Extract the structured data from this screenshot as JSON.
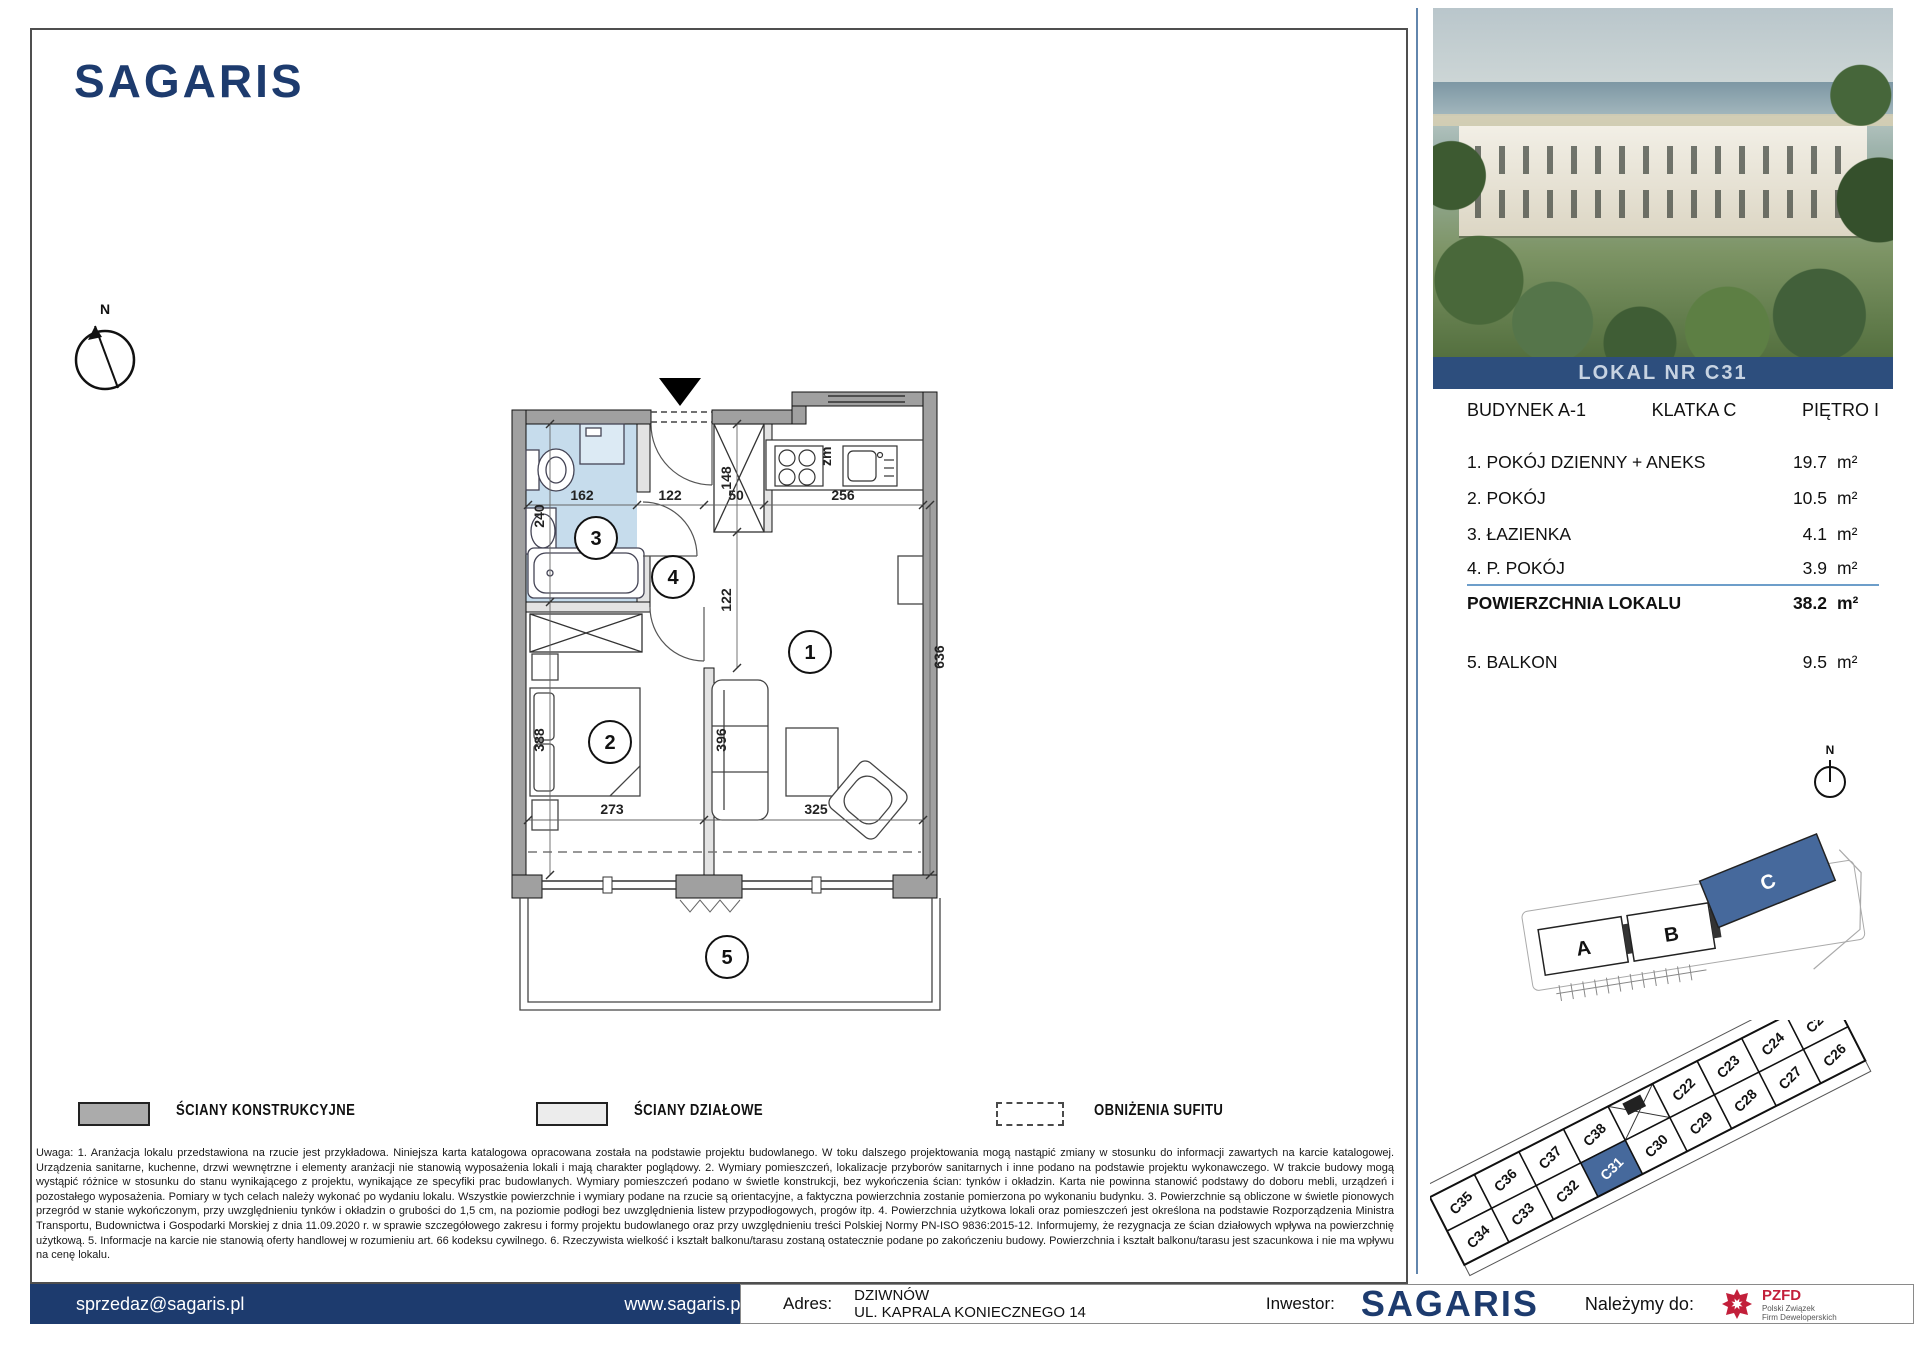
{
  "brand": {
    "name": "SAGARIS",
    "color": "#1d3b6e"
  },
  "plan": {
    "north_label": "N",
    "rooms": {
      "r1": "1",
      "r2": "2",
      "r3": "3",
      "r4": "4",
      "r5": "5"
    },
    "dims": {
      "bath_w": "162",
      "hall_w": "122",
      "closet_w": "50",
      "kitchen_w": "256",
      "closet_h": "148",
      "hall_h": "122",
      "bath_h": "240",
      "living_h": "636",
      "bed_h": "388",
      "sofa_h": "396",
      "bed_w": "273",
      "living_w": "325",
      "kitchen_note": "zm"
    }
  },
  "legend": {
    "items": [
      {
        "label": "ŚCIANY KONSTRUKCYJNE"
      },
      {
        "label": "ŚCIANY DZIAŁOWE"
      },
      {
        "label": "OBNIŻENIA SUFITU"
      }
    ]
  },
  "disclaimer": "Uwaga:   1. Aranżacja lokalu przedstawiona na rzucie jest przykładowa. Niniejsza karta katalogowa opracowana została na podstawie projektu budowlanego. W toku dalszego projektowania mogą nastąpić zmiany w stosunku do informacji zawartych na karcie katalogowej. Urządzenia sanitarne, kuchenne, drzwi wewnętrzne i elementy aranżacji nie stanowią wyposażenia lokali i mają charakter poglądowy.   2. Wymiary pomieszczeń, lokalizacje przyborów sanitarnych i inne podano na podstawie projektu wykonawczego. W trakcie budowy mogą wystąpić różnice w stosunku do stanu wynikającego z projektu, wynikające ze specyfiki prac budowlanych. Wymiary pomieszczeń podano w świetle konstrukcji, bez wykończenia ścian: tynków i okładzin. Karta nie powinna stanowić podstawy do doboru mebli, urządzeń i pozostałego wyposażenia. Pomiary w tych celach należy wykonać po wydaniu lokalu. Wszystkie powierzchnie i wymiary podane na rzucie są orientacyjne, a faktyczna powierzchnia zostanie pomierzona po wykonaniu budynku.   3. Powierzchnie są obliczone w świetle pionowych przegród w stanie wykończonym, przy uwzględnieniu tynków i okładzin o grubości do 1,5 cm, na poziomie podłogi bez uwzględnienia listew przypodłogowych, progów itp.   4. Powierzchnia użytkowa lokali oraz pomieszczeń jest określona na podstawie Rozporządzenia Ministra Transportu, Budownictwa i Gospodarki Morskiej z dnia 11.09.2020 r. w sprawie szczegółowego zakresu i formy projektu budowlanego oraz przy uwzględnieniu treści Polskiej Normy PN-ISO 9836:2015-12. Informujemy, że rezygnacja ze ścian działowych wpływa na powierzchnię użytkową. 5. Informacje na karcie nie stanowią oferty handlowej w rozumieniu art. 66 kodeksu cywilnego.   6. Rzeczywista wielkość i kształt balkonu/tarasu zostaną ostatecznie podane po zakończeniu budowy. Powierzchnia i kształt balkonu/tarasu jest szacunkowa i nie ma wpływu na cenę lokalu.",
  "panel": {
    "banner": "LOKAL NR C31",
    "header": {
      "building": "BUDYNEK A-1",
      "staircase": "KLATKA C",
      "floor": "PIĘTRO I"
    },
    "rooms": [
      {
        "name": "1. POKÓJ DZIENNY + ANEKS",
        "area": "19.7",
        "unit": "m²"
      },
      {
        "name": "2. POKÓJ",
        "area": "10.5",
        "unit": "m²"
      },
      {
        "name": "3. ŁAZIENKA",
        "area": "4.1",
        "unit": "m²"
      },
      {
        "name": "4. P. POKÓJ",
        "area": "3.9",
        "unit": "m²"
      }
    ],
    "total": {
      "name": "POWIERZCHNIA LOKALU",
      "area": "38.2",
      "unit": "m²"
    },
    "balcony": {
      "name": "5. BALKON",
      "area": "9.5",
      "unit": "m²"
    },
    "north_label": "N",
    "siteplan": {
      "a": "A",
      "b": "B",
      "c": "C",
      "highlight_color": "#46699c"
    },
    "grid": {
      "top": [
        "C35",
        "C36",
        "C37",
        "C38",
        "C22",
        "C23",
        "C24",
        "C25"
      ],
      "bottom": [
        "C34",
        "C33",
        "C32",
        "C31",
        "C30",
        "C29",
        "C28",
        "C27",
        "C26"
      ],
      "highlighted": "C31"
    }
  },
  "footer": {
    "email": "sprzedaz@sagaris.pl",
    "website": "www.sagaris.pl",
    "address_label": "Adres:",
    "address_line1": "DZIWNÓW",
    "address_line2": "UL. KAPRALA KONIECZNEGO 14",
    "investor_label": "Inwestor:",
    "investor_name": "SAGARIS",
    "member_label": "Należymy do:",
    "member_org": "PZFD",
    "member_org_line1": "Polski Związek",
    "member_org_line2": "Firm Deweloperskich"
  }
}
